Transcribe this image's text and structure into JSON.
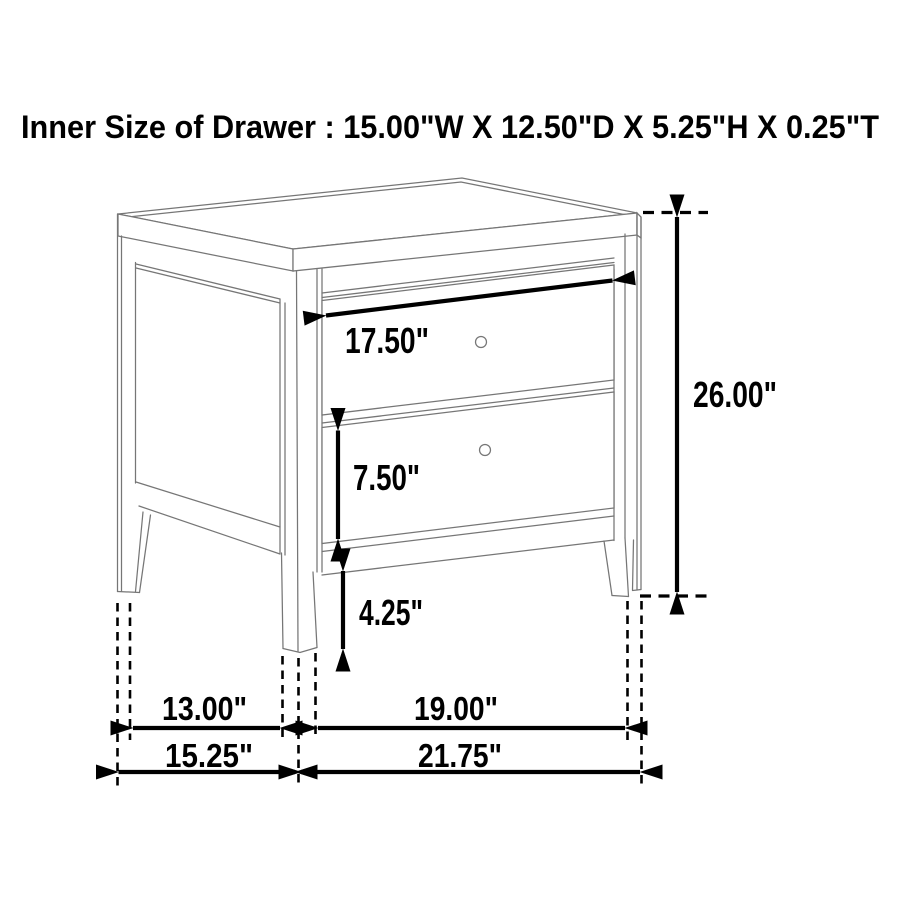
{
  "title": "Inner Size of Drawer : 15.00\"W X 12.50\"D X 5.25\"H X 0.25\"T",
  "labels": {
    "drawer_width": "17.50\"",
    "drawer_height": "7.50\"",
    "leg_height": "4.25\"",
    "overall_height": "26.00\"",
    "side_span_inner": "13.00\"",
    "side_depth_outer": "15.25\"",
    "front_span_inner": "19.00\"",
    "front_width_outer": "21.75\""
  },
  "colors": {
    "background": "#ffffff",
    "furniture_line": "#767676",
    "annotation": "#000000"
  }
}
